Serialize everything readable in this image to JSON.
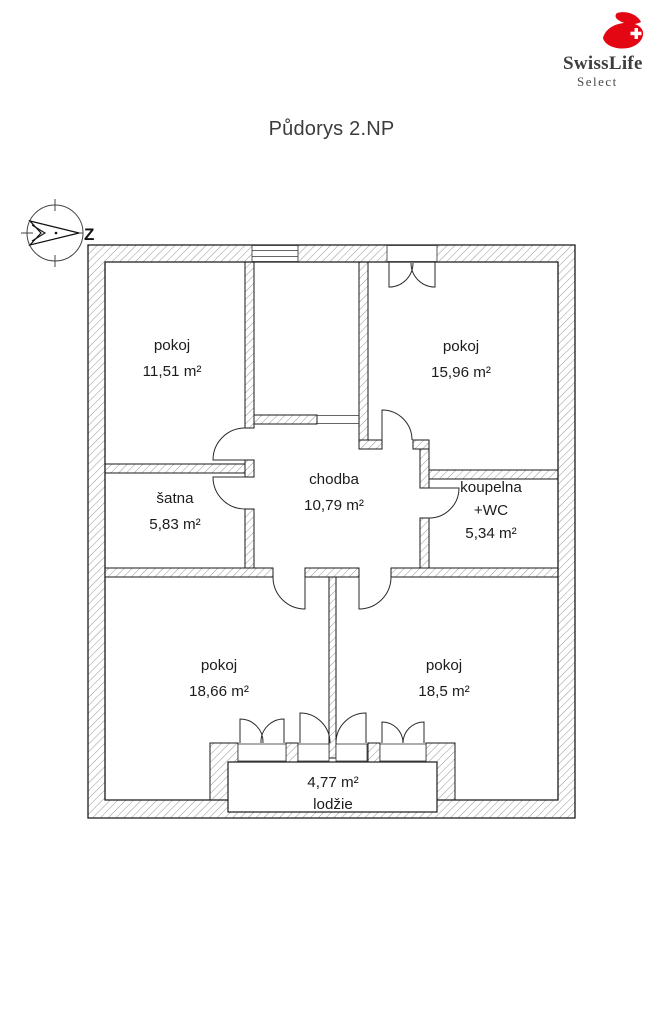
{
  "header": {
    "title": "Půdorys 2.NP"
  },
  "logo": {
    "brand": "SwissLife",
    "product": "Select",
    "brand_color": "#e30613",
    "text_color": "#3d3d3d"
  },
  "compass": {
    "direction_label": "Z"
  },
  "colors": {
    "wall_line": "#1a1a1a",
    "hatch": "#8a8a8a",
    "background": "#ffffff"
  },
  "floorplan": {
    "rooms": [
      {
        "id": "pokoj-nw",
        "name": "pokoj",
        "area": "11,51 m²"
      },
      {
        "id": "pokoj-ne",
        "name": "pokoj",
        "area": "15,96 m²"
      },
      {
        "id": "satna",
        "name": "šatna",
        "area": "5,83 m²"
      },
      {
        "id": "chodba",
        "name": "chodba",
        "area": "10,79 m²"
      },
      {
        "id": "koupelna",
        "name": "koupelna",
        "name2": "+WC",
        "area": "5,34 m²"
      },
      {
        "id": "pokoj-sw",
        "name": "pokoj",
        "area": "18,66 m²"
      },
      {
        "id": "pokoj-se",
        "name": "pokoj",
        "area": "18,5 m²"
      },
      {
        "id": "lodzie",
        "name": "lodžie",
        "area": "4,77 m²"
      }
    ]
  }
}
